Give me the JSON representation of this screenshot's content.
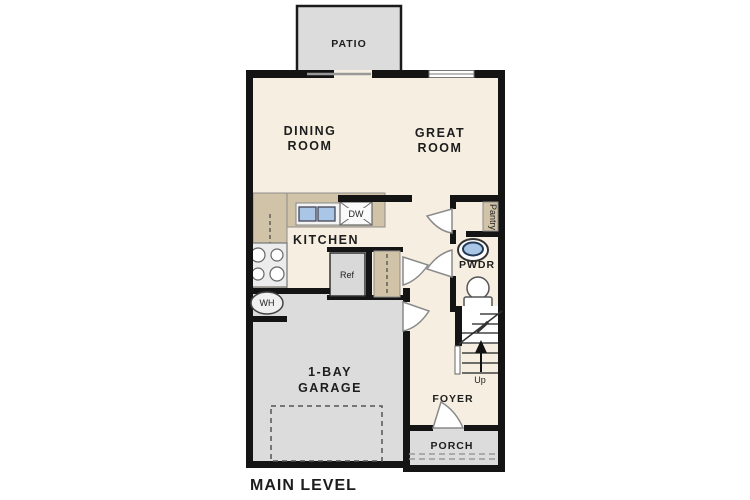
{
  "title": "MAIN LEVEL",
  "colors": {
    "wall": "#141414",
    "floor": "#f6efe1",
    "counter": "#d1c3a8",
    "concrete": "#dcdcdc",
    "sink_blue": "#a9c6e6",
    "text": "#1d1d1d"
  },
  "rooms": {
    "patio": {
      "label": "PATIO"
    },
    "dining": {
      "line1": "DINING",
      "line2": "ROOM"
    },
    "great": {
      "line1": "GREAT",
      "line2": "ROOM"
    },
    "kitchen": {
      "label": "KITCHEN"
    },
    "pwdr": {
      "label": "PWDR"
    },
    "garage": {
      "line1": "1-BAY",
      "line2": "GARAGE"
    },
    "foyer": {
      "label": "FOYER"
    },
    "porch": {
      "label": "PORCH"
    }
  },
  "fixtures": {
    "dishwasher": "DW",
    "refrigerator": "Ref",
    "pantry": "Pantry",
    "water_heater": "WH",
    "stairs_up": "Up"
  }
}
